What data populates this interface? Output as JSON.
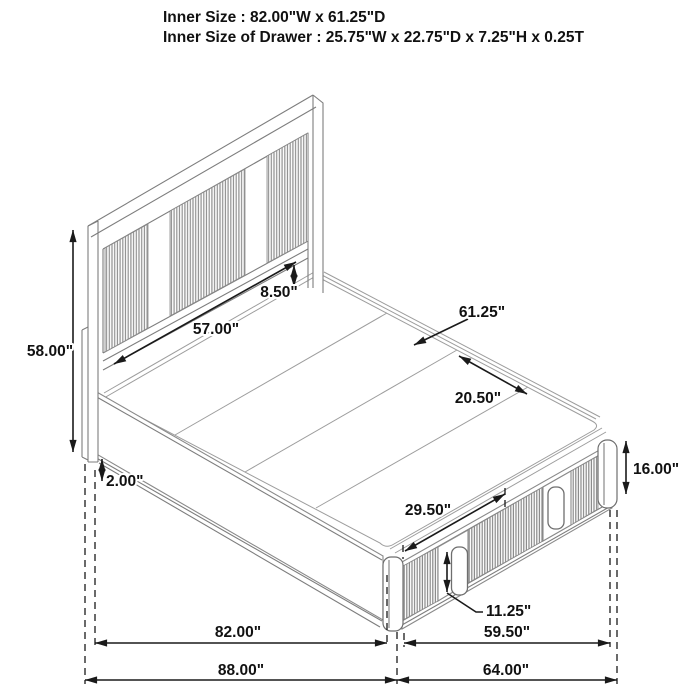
{
  "title": {
    "line1": "Inner Size : 82.00\"W x 61.25\"D",
    "line2": "Inner Size of Drawer : 25.75\"W x 22.75\"D x 7.25\"H x 0.25T"
  },
  "dimensions": {
    "headboard_height": "58.00\"",
    "base_height": "2.00\"",
    "headboard_inner_width": "57.00\"",
    "headboard_rail_clearance": "8.50\"",
    "inner_depth": "61.25\"",
    "deck_panel_width": "20.50\"",
    "platform_height": "16.00\"",
    "drawer_front_width": "29.50\"",
    "drawer_handle_height": "11.25\"",
    "inner_length": "82.00\"",
    "drawer_section_width": "59.50\"",
    "overall_length": "88.00\"",
    "overall_width": "64.00\""
  },
  "colors": {
    "dimension_line": "#1a1a1a",
    "drawing_line": "#8a8a8a",
    "background": "#ffffff"
  }
}
